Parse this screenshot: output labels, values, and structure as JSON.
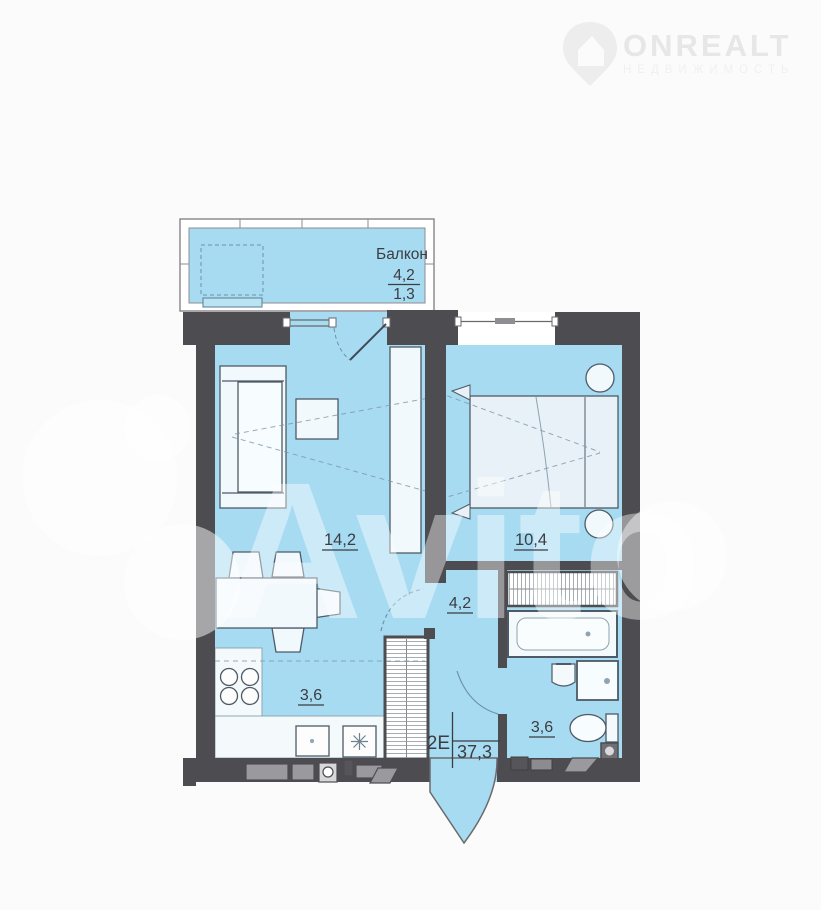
{
  "branding": {
    "logo_text": "ONREALT",
    "logo_subtitle": "НЕДВИЖИМОСТЬ",
    "watermark_text": "Avito"
  },
  "apartment": {
    "type_label": "2Е",
    "total_area": "37,3"
  },
  "rooms": {
    "balcony": {
      "name": "Балкон",
      "area_full": "4,2",
      "area_counted": "1,3"
    },
    "living_room": {
      "area": "14,2"
    },
    "bedroom": {
      "area": "10,4"
    },
    "hallway": {
      "area": "4,2"
    },
    "kitchen": {
      "area": "3,6"
    },
    "bathroom": {
      "area": "3,6"
    }
  },
  "colors": {
    "wall": "#4c4c51",
    "floor": "#a7dbf1",
    "furniture_fill": "#f2f9fc",
    "bed_fill": "#e8f1f7",
    "label_text": "#3b3d42",
    "logo_gray": "#e7e7e7"
  }
}
